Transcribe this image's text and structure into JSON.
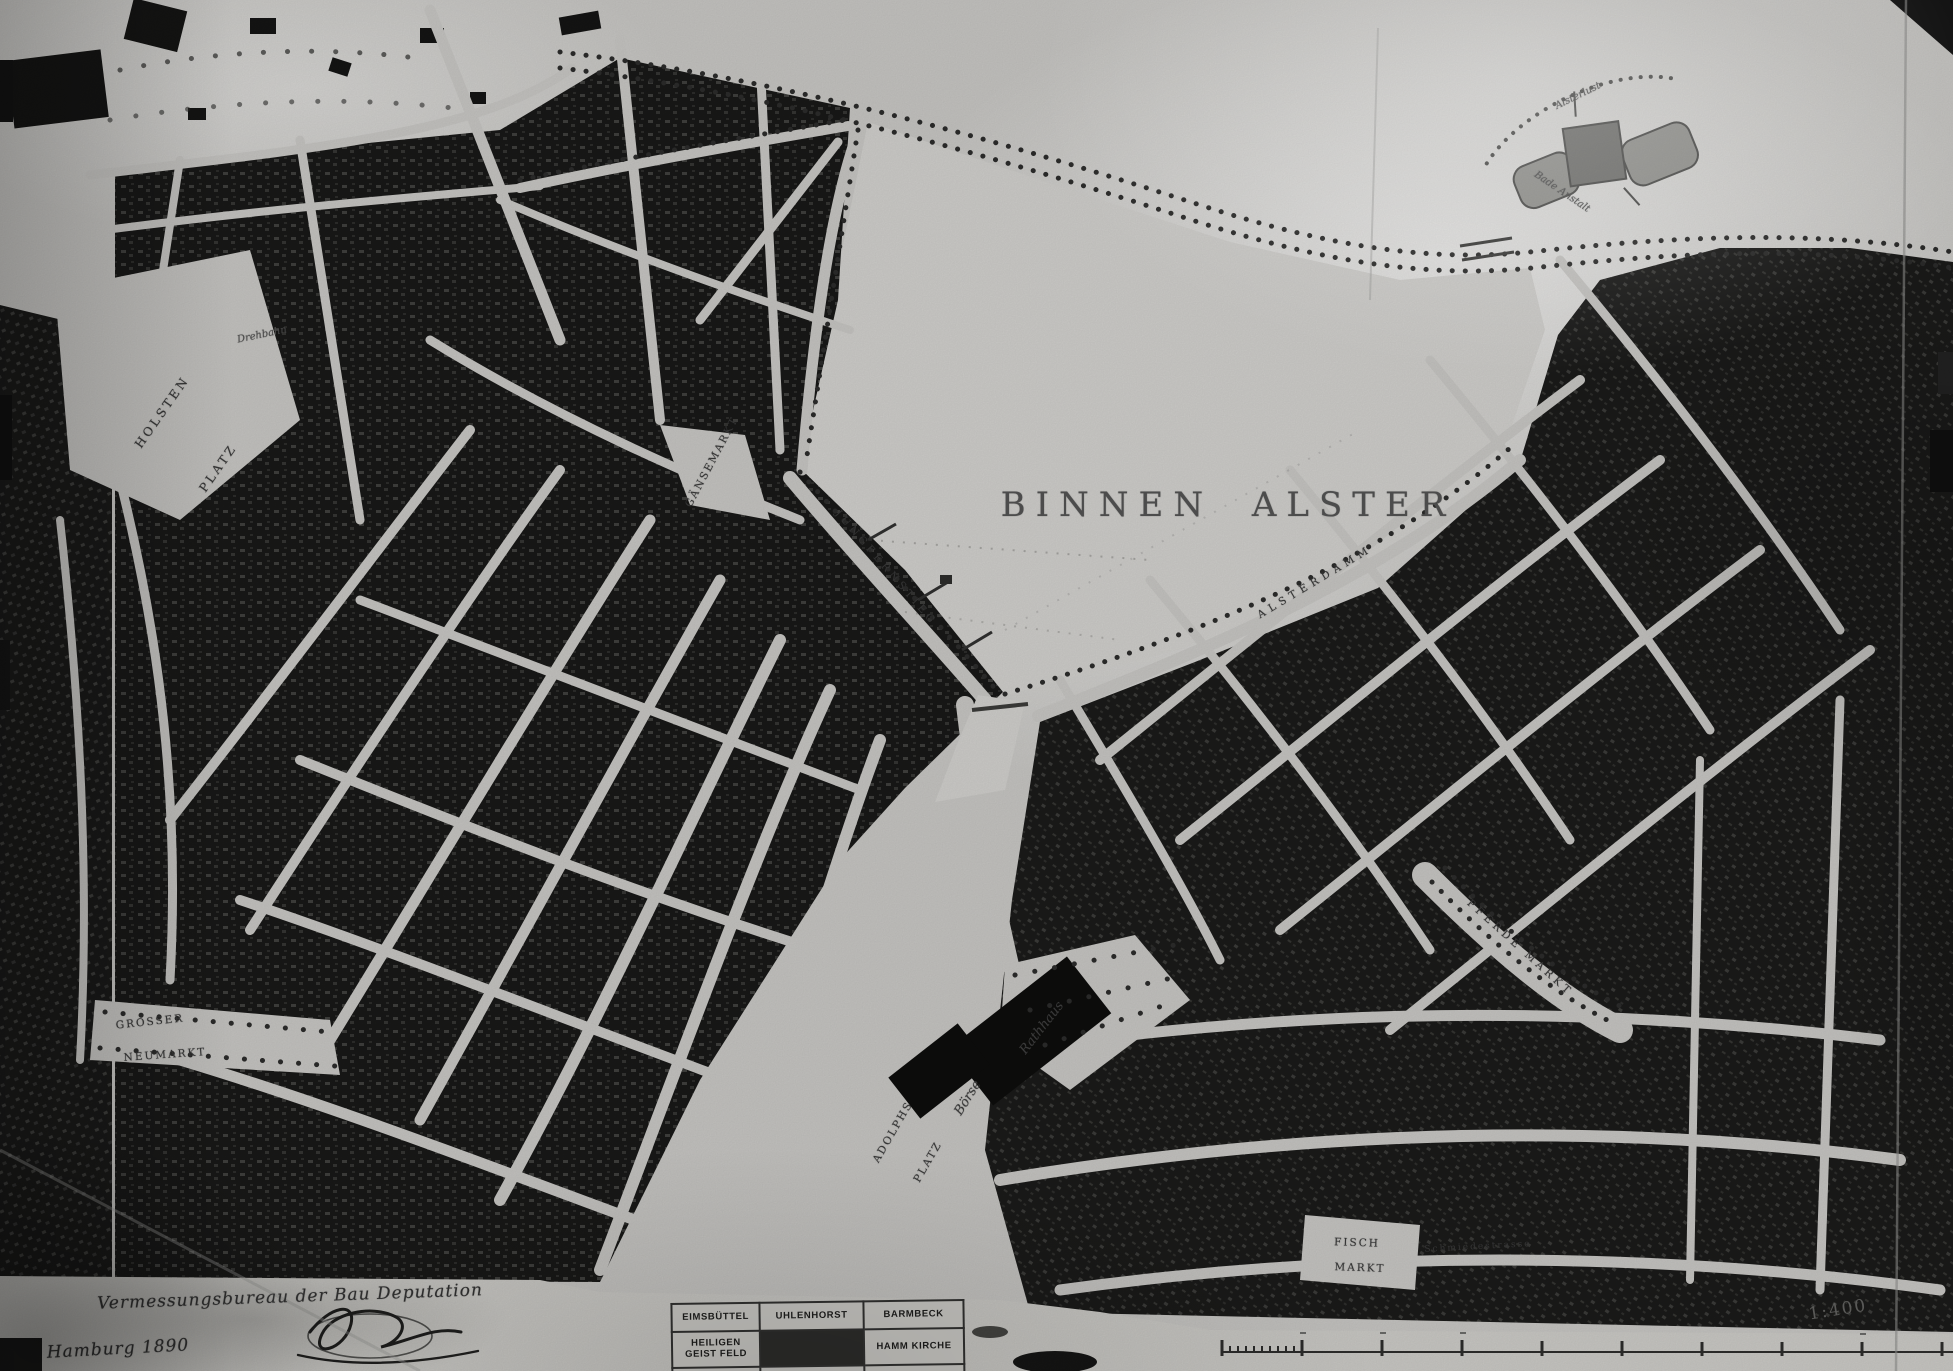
{
  "title": {
    "lake": "BINNEN ALSTER"
  },
  "labels": {
    "holsten_1": "HOLSTEN",
    "holsten_2": "PLATZ",
    "drehbahn": "Drehbahn",
    "gaensemarkt": "GÄNSEMARKT",
    "jungfernstieg": "JUNGFERNSTIEG",
    "alsterdamm": "ALSTERDAMM",
    "grosser": "GROSSER",
    "neumarkt": "NEUMARKT",
    "adolphs_1": "ADOLPHS",
    "adolphs_2": "PLATZ",
    "rathhaus": "Rathhaus",
    "boerse": "Börse",
    "fisch_1": "FISCH",
    "fisch_2": "MARKT",
    "pferdemarkt": "PFERDE MARKT",
    "schmiedestrasse": "Schmiedestrasse",
    "alsterlust": "Alsterlust",
    "bade_anstalt": "Bade Anstalt"
  },
  "imprint": {
    "bureau": "Vermessungsbureau der Bau Deputation",
    "place_year": "Hamburg 1890"
  },
  "scale": {
    "ratio": "1:400"
  },
  "index_table": {
    "r1c1": "EIMSBÜTTEL",
    "r1c2": "UHLENHORST",
    "r1c3": "BARMBECK",
    "r2c1": "HEILIGEN GEIST FELD",
    "r2c3": "HAMM KIRCHE"
  },
  "colors": {
    "paper": "#c2c1be",
    "city_blocks": "#181817",
    "label_ink": "#3f3f3f"
  }
}
